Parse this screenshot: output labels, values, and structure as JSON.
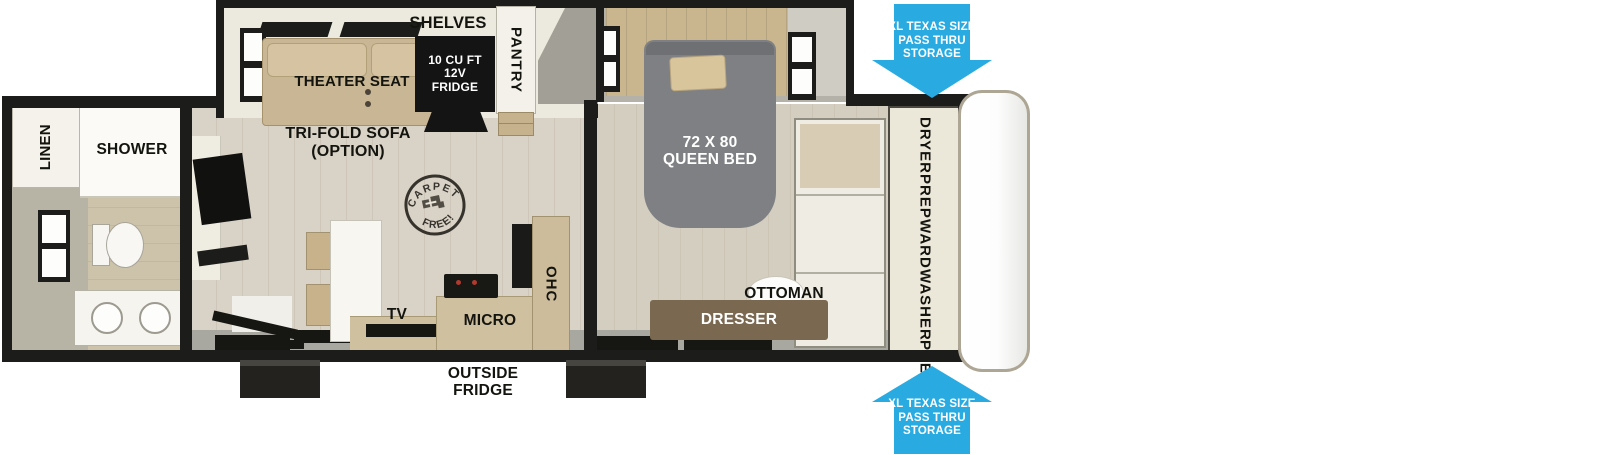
{
  "labels": {
    "linen": "LINEN",
    "shower": "SHOWER",
    "theater_seat": "THEATER SEAT",
    "trifold_sofa": [
      "TRI-FOLD SOFA",
      "(OPTION)"
    ],
    "shelves": "SHELVES",
    "pantry": "PANTRY",
    "fridge": [
      "10 CU FT",
      "12V",
      "FRIDGE"
    ],
    "carpet_stamp": [
      "CARPET",
      "FREE!"
    ],
    "tv": "TV",
    "micro": "MICRO",
    "ohc": "OHC",
    "outside_fridge": [
      "OUTSIDE",
      "FRIDGE"
    ],
    "queen_bed": [
      "72 X 80",
      "QUEEN BED"
    ],
    "ottoman": "OTTOMAN",
    "dresser": "DRESSER",
    "dryer_prep": [
      "DRYER",
      "PREP"
    ],
    "ward": "WARD",
    "washer_prep": [
      "WASHER",
      "PREP"
    ],
    "pass_thru_top": [
      "XL TEXAS SIZE",
      "PASS THRU",
      "STORAGE"
    ],
    "pass_thru_bottom": [
      "XL TEXAS SIZE",
      "PASS THRU",
      "STORAGE"
    ]
  },
  "colors": {
    "arrow_blue": "#29abe2",
    "wall_black": "#1c1c1a",
    "bed_gray": "#7e8083",
    "dresser_brown": "#7b6850",
    "floor_tan": "#d9d2c6",
    "seat_tan": "#c8b694",
    "counter_tan": "#cfc09f"
  }
}
